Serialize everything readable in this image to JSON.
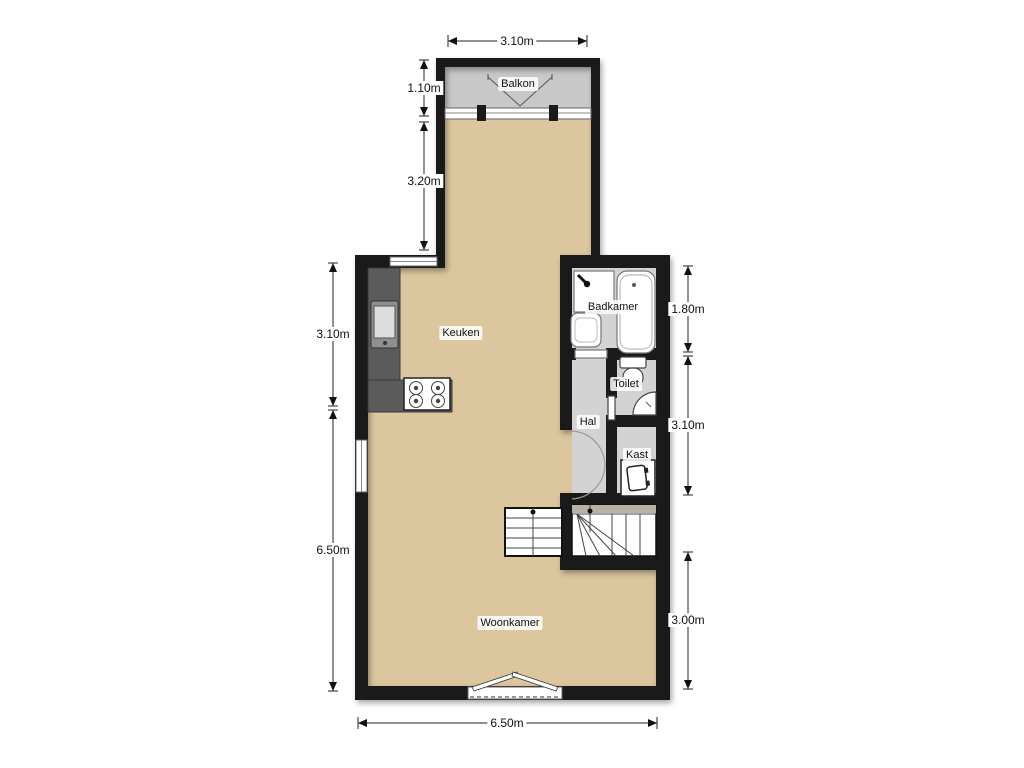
{
  "plan": {
    "title": "apartment-floor-plan",
    "rooms": {
      "balcony": {
        "label": "Balkon"
      },
      "kitchen": {
        "label": "Keuken"
      },
      "bathroom": {
        "label": "Badkamer"
      },
      "toilet": {
        "label": "Toilet"
      },
      "hall": {
        "label": "Hal"
      },
      "closet": {
        "label": "Kast"
      },
      "living": {
        "label": "Woonkamer"
      }
    },
    "dimensions": {
      "top_width": "3.10m",
      "balcony_depth": "1.10m",
      "upper_section": "3.20m",
      "kitchen_side": "3.10m",
      "living_side": "6.50m",
      "bathroom_side": "1.80m",
      "hall_side": "3.10m",
      "living_right": "3.00m",
      "bottom_width": "6.50m"
    },
    "colors": {
      "wall": "#1a1a1a",
      "floor": "#dcc69e",
      "balcony_floor": "#c8c8c8",
      "wet_floor": "#d3d3d3",
      "counter": "#5b5b5b"
    }
  }
}
